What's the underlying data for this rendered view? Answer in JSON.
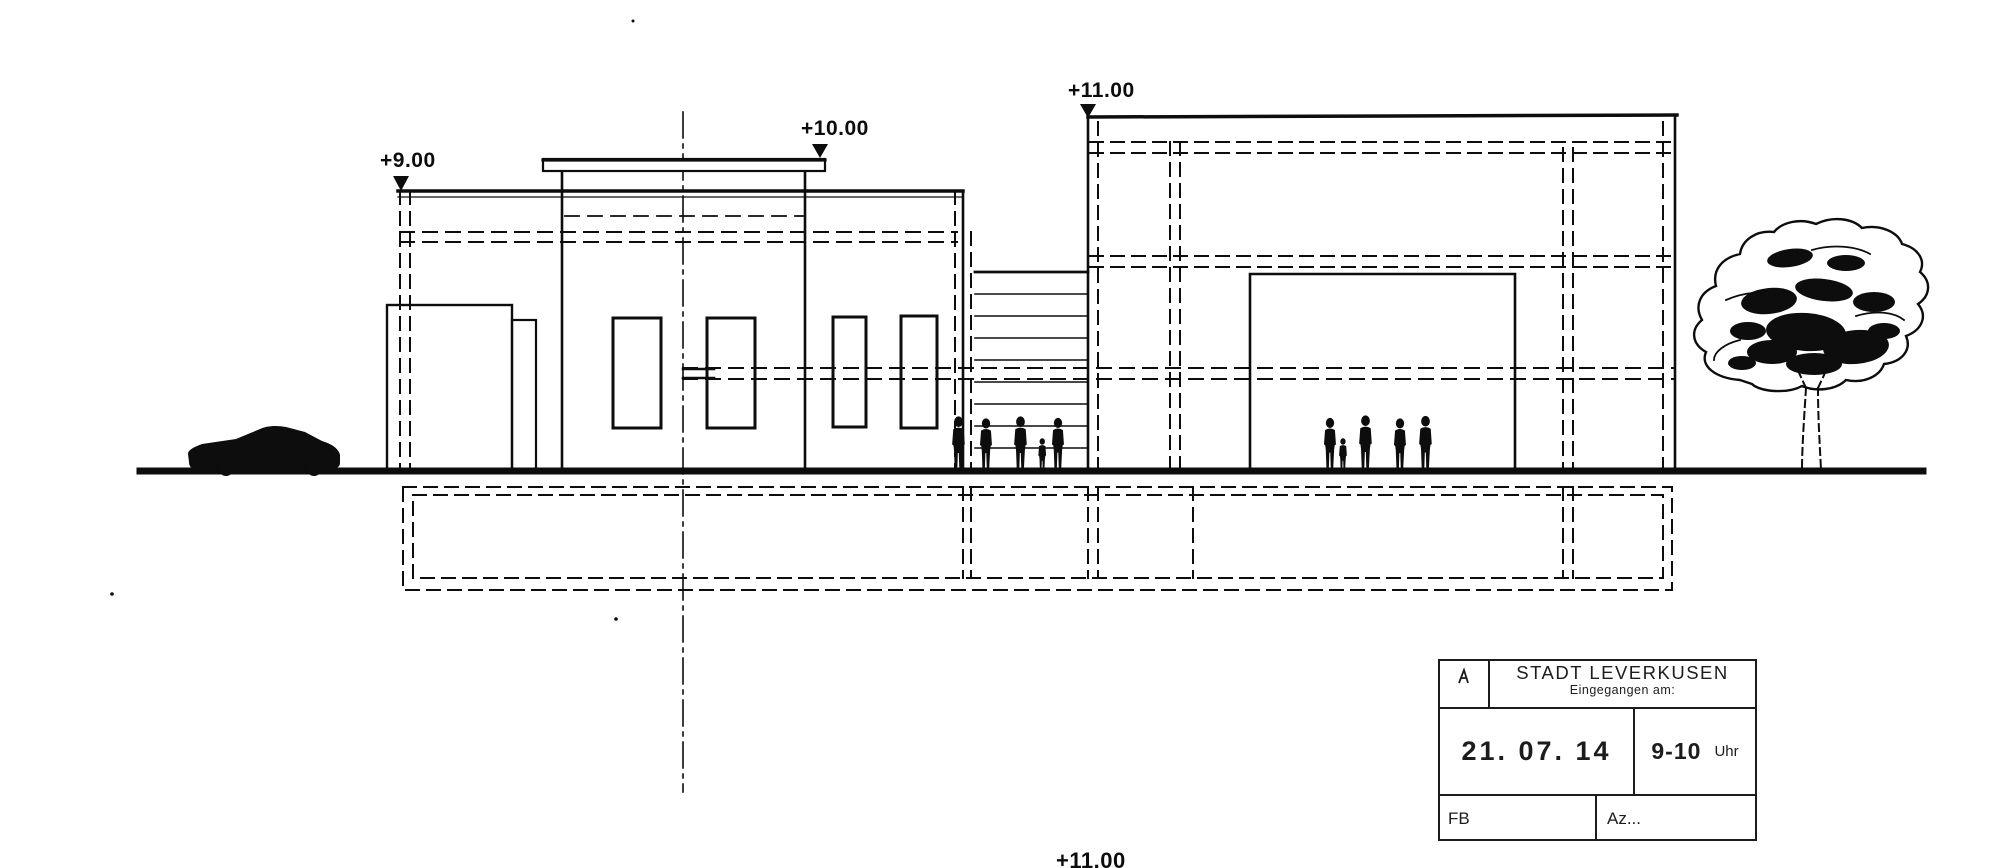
{
  "meta": {
    "description": "Scanned architectural street elevation drawing with municipal receipt stamp"
  },
  "colors": {
    "ink": "#0d0d0d",
    "paper": "#ffffff",
    "stamp_ink": "#1c1c1c"
  },
  "elevation_markers": {
    "m9": {
      "label": "+9.00"
    },
    "m10": {
      "label": "+10.00"
    },
    "m11": {
      "label": "+11.00"
    },
    "m11_bottom": {
      "label": "+11.00"
    }
  },
  "stamp": {
    "title": "STADT LEVERKUSEN",
    "subtitle": "Eingegangen am:",
    "date": "21. 07. 14",
    "time": "9-10",
    "time_unit": "Uhr",
    "dept_label": "FB",
    "file_label": "Az..."
  }
}
